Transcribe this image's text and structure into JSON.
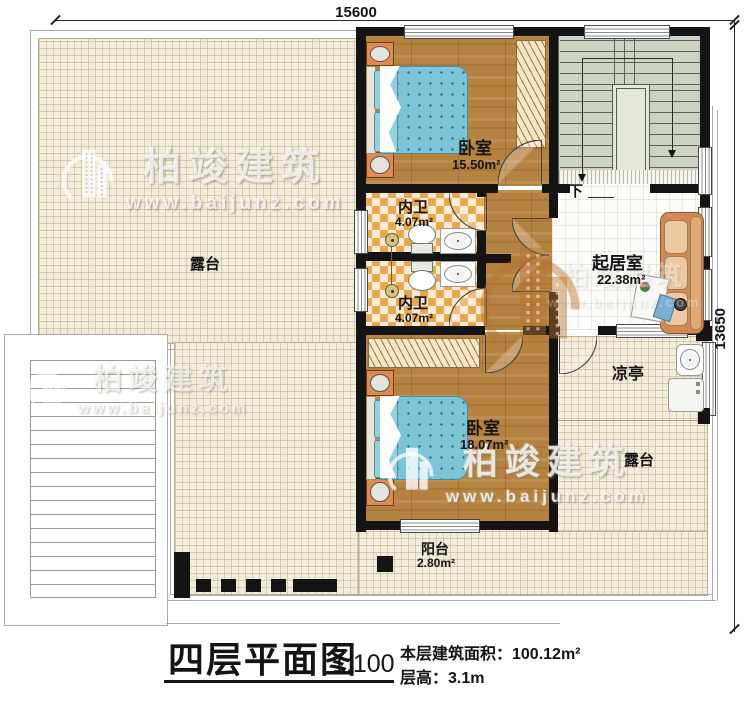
{
  "dimensions": {
    "width": "15600",
    "height": "13650"
  },
  "rooms": {
    "bedroom_top": {
      "name": "卧室",
      "area": "15.50m²"
    },
    "bath_top": {
      "name": "内卫",
      "area": "4.07m²"
    },
    "bath_bottom": {
      "name": "内卫",
      "area": "4.07m²"
    },
    "living_room": {
      "name": "起居室",
      "area": "22.38m²"
    },
    "bedroom_bottom": {
      "name": "卧室",
      "area": "18.07m²"
    },
    "balcony": {
      "name": "阳台",
      "area": "2.80m²"
    },
    "terrace_left": {
      "name": "露台"
    },
    "terrace_right": {
      "name": "露台"
    },
    "pavilion": {
      "name": "凉亭"
    },
    "stair_direction": {
      "label": "下"
    }
  },
  "title_block": {
    "title": "四层平面图",
    "scale": "1:100",
    "floor_area": "本层建筑面积：100.12m²",
    "floor_height": "层高：3.1m"
  },
  "watermark": {
    "brand": "柏竣建筑",
    "url": "www.baijunz.com"
  },
  "colors": {
    "wall": "#141414",
    "wood": "#b5823f",
    "terrace_tile": "#f2ecda",
    "bath_checker": "#e9a84f",
    "stairs": "#ccd3c4",
    "living_tile": "#fbfbf8",
    "bed": "#7cc4d6",
    "sofa": "#cf8a58"
  }
}
